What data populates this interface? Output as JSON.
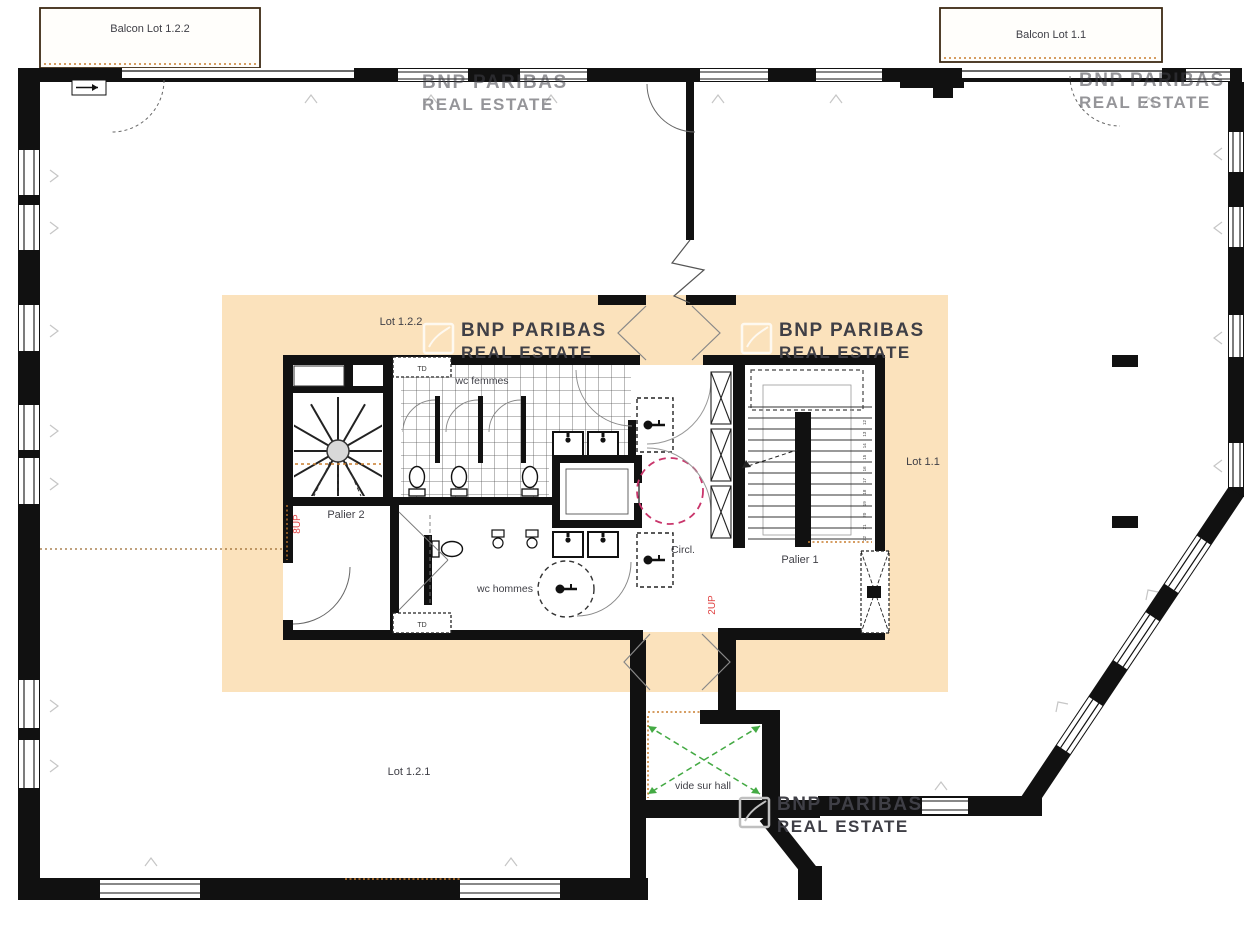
{
  "labels": {
    "balcon_left": "Balcon Lot 1.2.2",
    "balcon_right": "Balcon Lot 1.1",
    "lot_122": "Lot 1.2.2",
    "lot_11": "Lot 1.1",
    "lot_121": "Lot 1.2.1",
    "palier_1": "Palier 1",
    "palier_2": "Palier 2",
    "wc_femmes": "wc femmes",
    "wc_hommes": "wc hommes",
    "circulation": "Circl.",
    "vide_sur_hall": "vide sur hall",
    "td": "TD"
  },
  "annotations": {
    "up_main_stair": "2UP",
    "up_spiral_stair": "8UP",
    "main_stair_tread_numbers": [
      "12",
      "13",
      "14",
      "15",
      "16",
      "17",
      "18",
      "19",
      "20",
      "21",
      "22"
    ]
  },
  "watermark": {
    "line1": "BNP PARIBAS",
    "line2": "REAL ESTATE"
  },
  "colors": {
    "wall": "#111111",
    "core_highlight": "#fbe2bc",
    "annotation_red": "#e04545",
    "turning_circle_pink": "#c9356b",
    "void_cross_green": "#44aa44",
    "survey_dots_orange": "#c87d2e",
    "watermark_gray": "#c0c0c0",
    "label_text": "#3f3f46"
  }
}
